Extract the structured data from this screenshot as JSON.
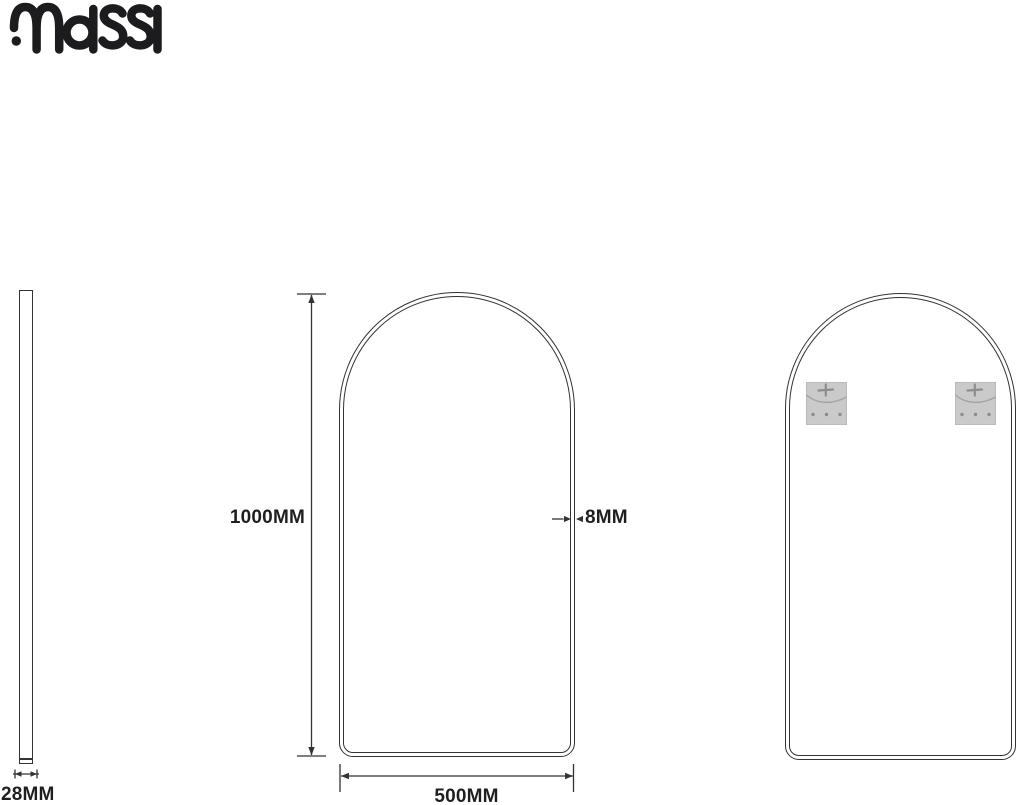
{
  "brand": {
    "name": "massi",
    "color": "#1c1c1e"
  },
  "views": {
    "side": {
      "depth_label": "28MM"
    },
    "front": {
      "height_label": "1000MM",
      "width_label": "500MM",
      "edge_label": "8MM"
    },
    "back": {
      "bracket_count": 2,
      "bracket_icon": "mounting-bracket-icon",
      "bracket_color": "#cacaca"
    }
  },
  "drawing": {
    "background": "#ffffff",
    "line_color": "#333333",
    "text_color": "#1f1f1f"
  }
}
